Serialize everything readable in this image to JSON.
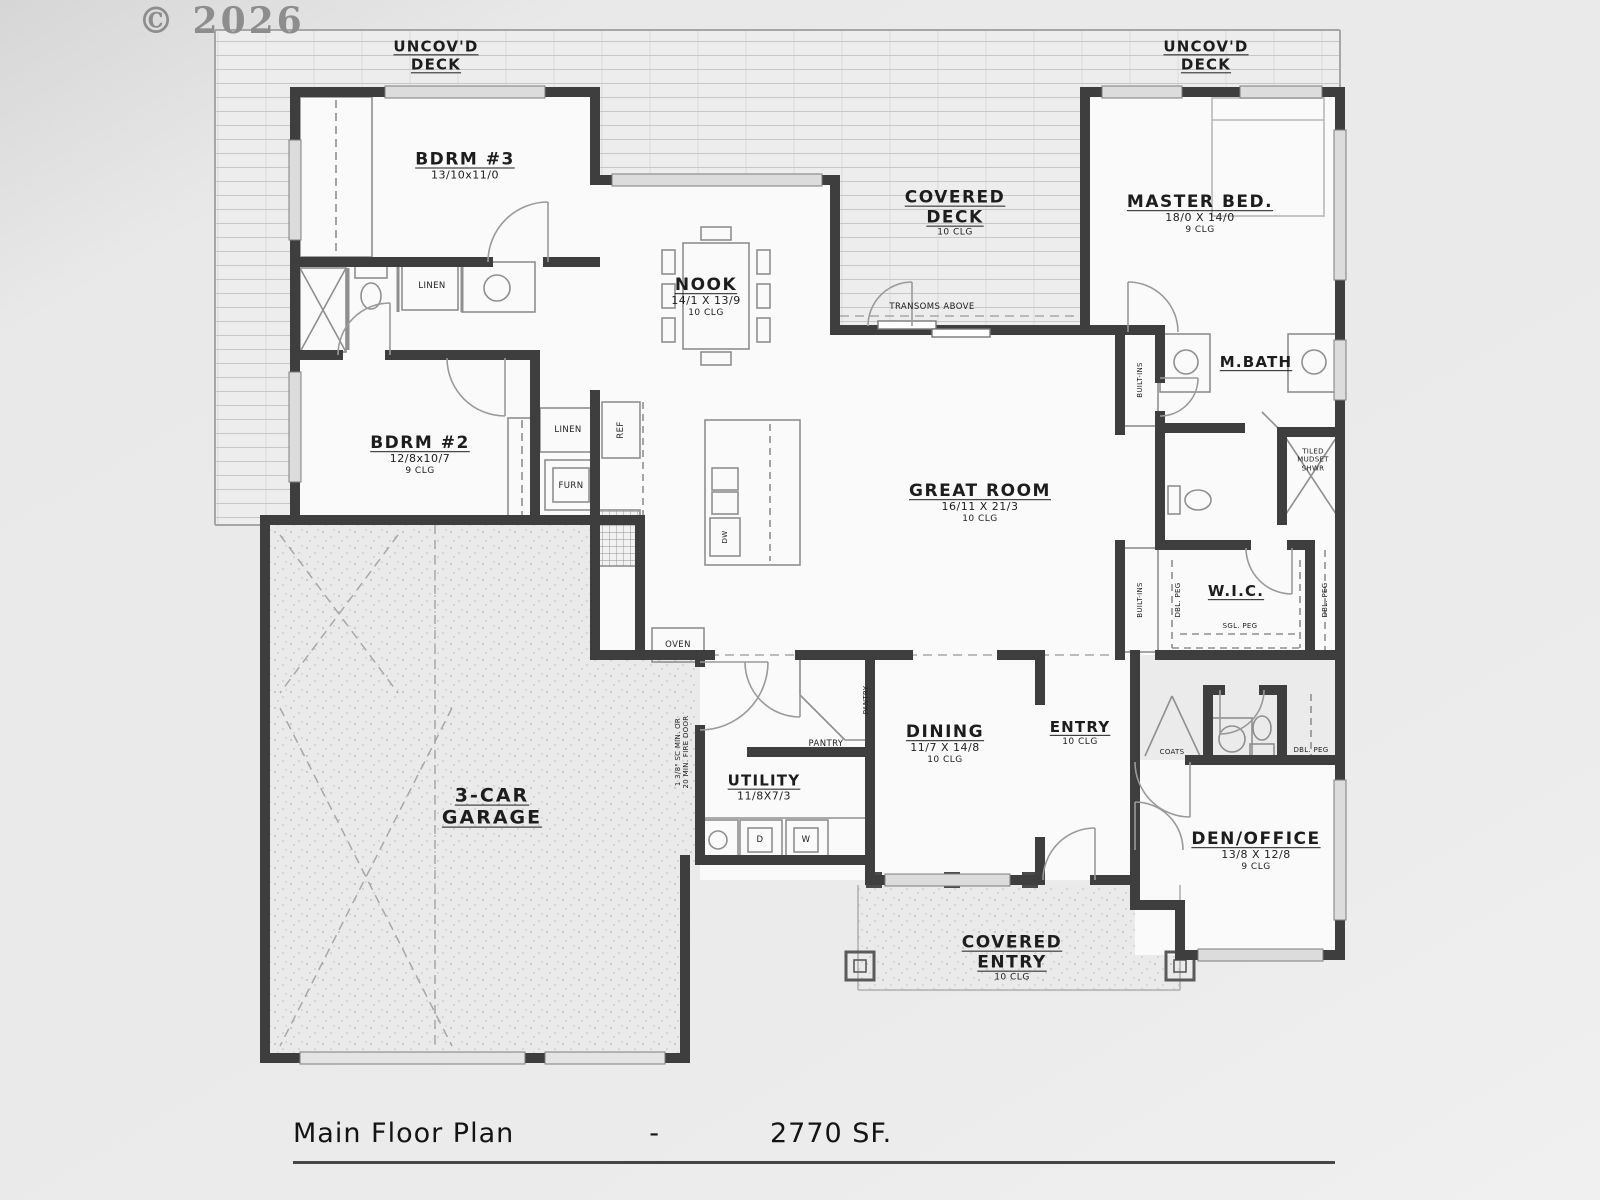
{
  "watermark": "© 2026",
  "plan": {
    "title": "Main Floor Plan",
    "title_dash": "-",
    "title_area": "2770 SF."
  },
  "rooms": {
    "uncovd_deck": {
      "l1": "UNCOV'D",
      "l2": "DECK"
    },
    "bdrm3": {
      "name": "BDRM #3",
      "dims": "13/10x11/0"
    },
    "covered_deck": {
      "l1": "COVERED",
      "l2": "DECK",
      "clg": "10 CLG"
    },
    "master_bed": {
      "name": "MASTER BED.",
      "dims": "18/0 X 14/0",
      "clg": "9 CLG"
    },
    "nook": {
      "name": "NOOK",
      "dims": "14/1 X 13/9",
      "clg": "10 CLG"
    },
    "mbath": {
      "name": "M.BATH"
    },
    "bdrm2": {
      "name": "BDRM #2",
      "dims": "12/8x10/7",
      "clg": "9 CLG"
    },
    "great_room": {
      "name": "GREAT ROOM",
      "dims": "16/11 X 21/3",
      "clg": "10 CLG"
    },
    "wic": {
      "name": "W.I.C."
    },
    "dining": {
      "name": "DINING",
      "dims": "11/7 X 14/8",
      "clg": "10 CLG"
    },
    "entry": {
      "name": "ENTRY",
      "clg": "10 CLG"
    },
    "utility": {
      "name": "UTILITY",
      "dims": "11/8X7/3"
    },
    "garage": {
      "l1": "3-CAR",
      "l2": "GARAGE"
    },
    "den_office": {
      "name": "DEN/OFFICE",
      "dims": "13/8 X 12/8",
      "clg": "9 CLG"
    },
    "covered_entry": {
      "l1": "COVERED",
      "l2": "ENTRY",
      "clg": "10 CLG"
    }
  },
  "labels": {
    "transoms": "TRANSOMS ABOVE",
    "linen_bath": "LINEN",
    "linen_hall": "LINEN",
    "furn": "FURN",
    "ref": "REF",
    "shwr_l1": "TILED",
    "shwr_l2": "MUDSET",
    "shwr_l3": "SHWR",
    "builtins": "BUILT-INS",
    "dbl_peg": "DBL. PEG",
    "sgl_peg": "SGL. PEG",
    "oven": "OVEN",
    "pantry": "PANTRY",
    "coats": "COATS",
    "fire_door_l1": "1 3/8\" SC MIN. OR",
    "fire_door_l2": "20 MIN. FIRE DOOR",
    "dryer": "D",
    "washer": "W",
    "dishwasher": "DW"
  },
  "colors": {
    "wall": "#3e3e3e",
    "background": "#ececec",
    "paper": "#fafafa",
    "deck_line": "#c7c7c7",
    "text": "#1d1d1d"
  }
}
